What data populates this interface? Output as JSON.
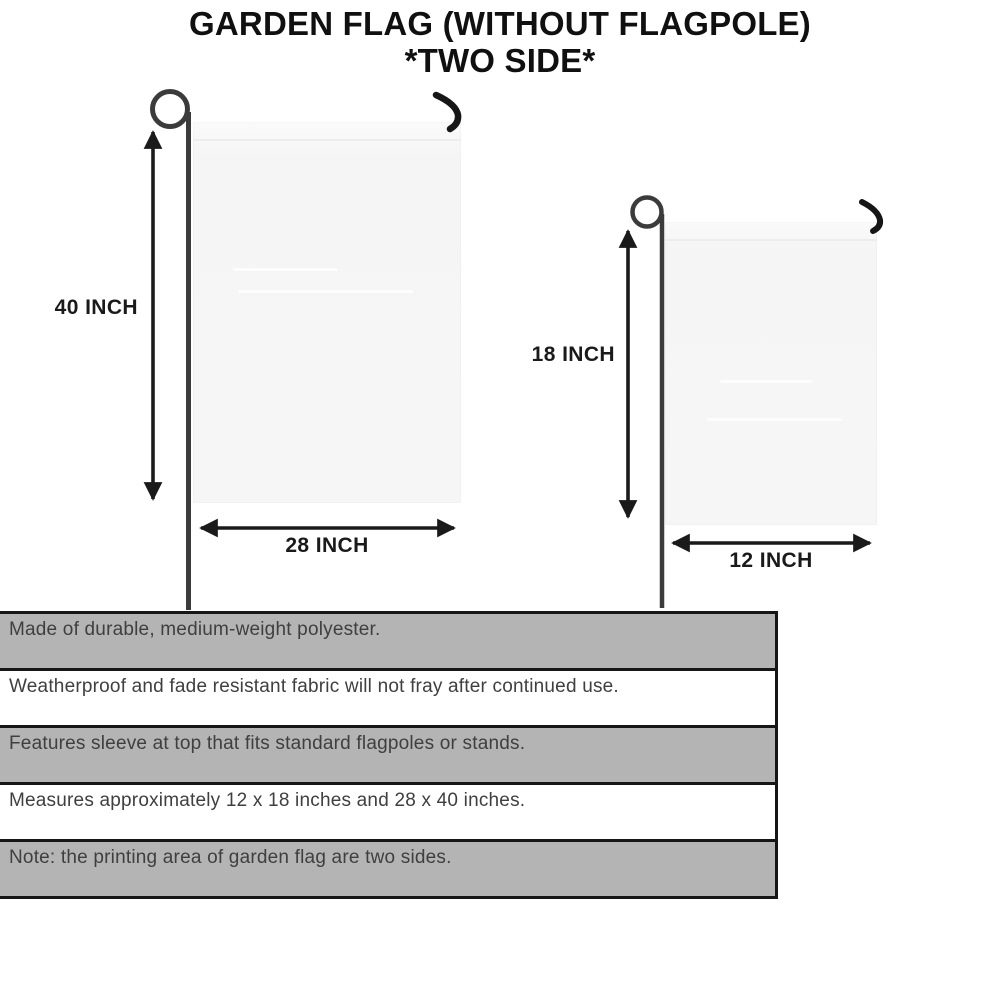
{
  "title": {
    "line1": "GARDEN FLAG (WITHOUT FLAGPOLE)",
    "line2": "*TWO SIDE*"
  },
  "flags": {
    "large": {
      "height_label": "40 INCH",
      "width_label": "28 INCH"
    },
    "small": {
      "height_label": "18 INCH",
      "width_label": "12 INCH"
    }
  },
  "features": [
    "Made of durable, medium-weight polyester.",
    "Weatherproof and fade resistant fabric will not fray after continued use.",
    "Features sleeve at top that fits standard flagpoles or stands.",
    "Measures approximately 12 x 18 inches and 28 x 40 inches.",
    "Note: the printing area of garden flag are two sides."
  ],
  "icons": {
    "pole_loop": "circle-outline",
    "hanger_hook": "curved-hook",
    "dimension_arrow": "double-headed-arrow"
  },
  "colors": {
    "ink": "#1a1a1a",
    "table_border": "#161616",
    "row_gray": "#b4b4b4",
    "row_white": "#ffffff",
    "row_text": "#3f3f3f",
    "flag_fill": "#f6f6f6",
    "pole": "#3b3b3b",
    "background": "#ffffff"
  }
}
